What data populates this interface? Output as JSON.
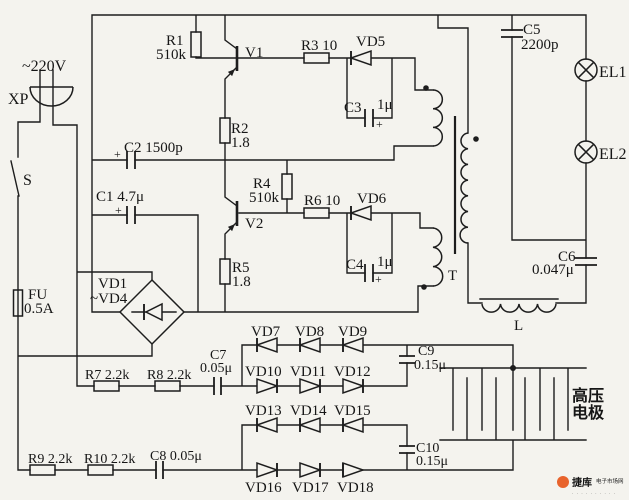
{
  "colors": {
    "ink": "#1d1d1d",
    "paper": "#f4f3ee",
    "watermark": "#e8632c"
  },
  "circuit": {
    "power": {
      "voltage": "~220V",
      "plug": "XP",
      "switch": "S",
      "fuse": "FU",
      "fuse_rating": "0.5A"
    },
    "oscillator": {
      "r1": "R1",
      "r1_value": "510k",
      "v1": "V1",
      "r2": "R2",
      "r2_value": "1.8",
      "r3": "R3 10",
      "vd5": "VD5",
      "c3": "C3",
      "c3_value": "1μ",
      "c2": "C2 1500p",
      "c1": "C1 4.7μ",
      "r4": "R4",
      "r4_value": "510k",
      "v2": "V2",
      "r5": "R5",
      "r5_value": "1.8",
      "r6": "R6 10",
      "vd6": "VD6",
      "c4": "C4",
      "c4_value": "1μ",
      "plus": "+"
    },
    "rectifier": {
      "label_line1": "VD1",
      "label_line2": "~VD4"
    },
    "transformer": {
      "label": "T"
    },
    "output": {
      "c5": "C5",
      "c5_value": "2200p",
      "el1": "EL1",
      "el2": "EL2",
      "c6": "C6",
      "c6_value": "0.047μ",
      "l": "L"
    },
    "multiplier": {
      "r7": "R7 2.2k",
      "r8": "R8 2.2k",
      "c7": "C7",
      "c7_value": "0.05μ",
      "r9": "R9 2.2k",
      "r10": "R10 2.2k",
      "c8": "C8 0.05μ",
      "c9": "C9",
      "c9_value": "0.15μ",
      "c10": "C10",
      "c10_value": "0.15μ",
      "vd_row1": [
        "VD7",
        "VD8",
        "VD9"
      ],
      "vd_row2": [
        "VD10",
        "VD11",
        "VD12"
      ],
      "vd_row3": [
        "VD13",
        "VD14",
        "VD15"
      ],
      "vd_row4": [
        "VD16",
        "VD17",
        "VD18"
      ]
    },
    "electrode": {
      "line1": "高压",
      "line2": "电极"
    }
  },
  "watermark": {
    "brand": "捷库",
    "caption": "电子市场网",
    "fineprint_illegible": "· · · · · · · · · ·"
  }
}
